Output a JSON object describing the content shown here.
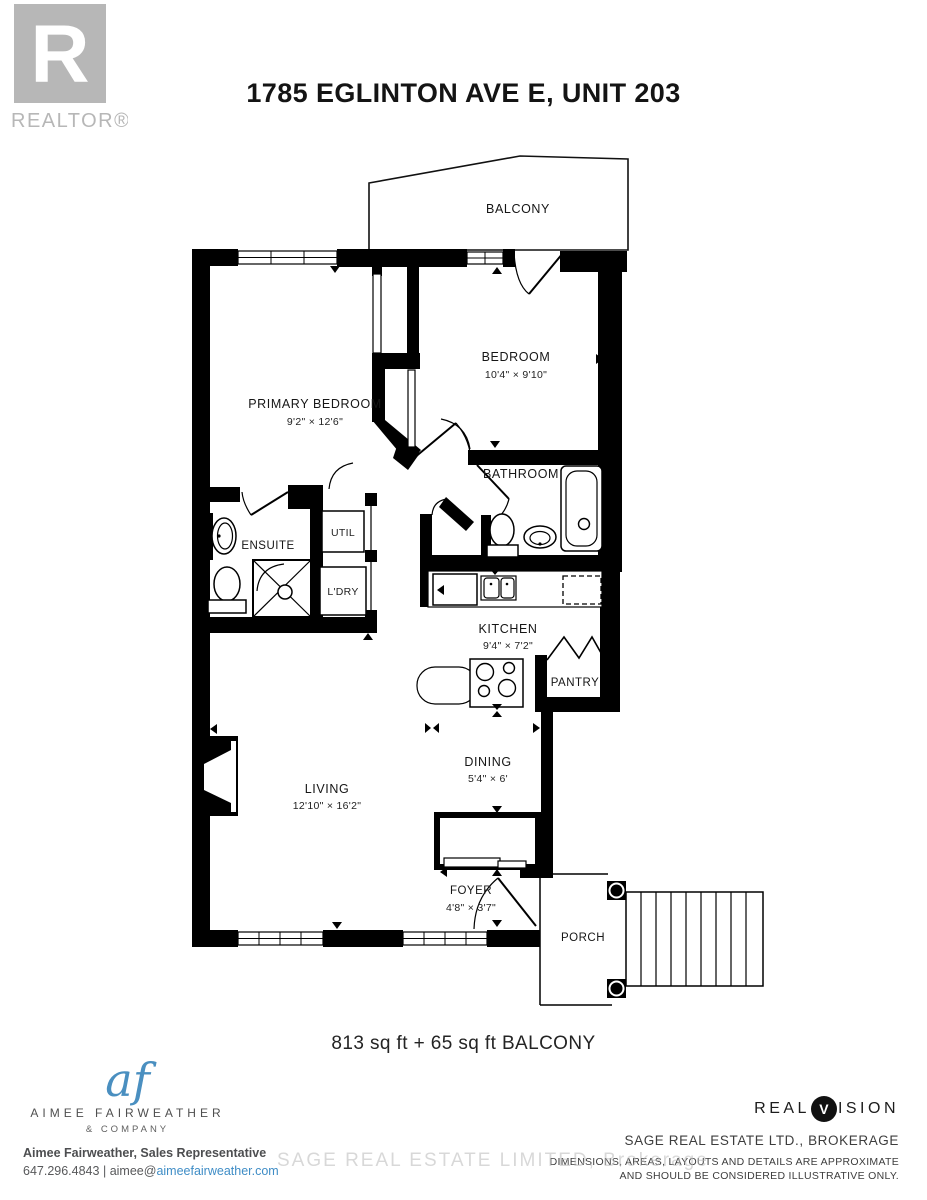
{
  "colors": {
    "wall": "#000000",
    "logo_gray": "#b7b7b7",
    "accent_blue": "#3f8dc6",
    "text_dark": "#1a1a1a",
    "watermark_gray": "#b9b9b9"
  },
  "header": {
    "title": "1785 EGLINTON AVE E, UNIT 203",
    "realtor_logo": {
      "letter": "R",
      "wordmark": "REALTOR®"
    }
  },
  "floorplan": {
    "area_text": "813 sq ft + 65 sq ft BALCONY",
    "rooms": {
      "balcony": {
        "label": "BALCONY"
      },
      "primary_bedroom": {
        "label": "PRIMARY BEDROOM",
        "dims": "9'2\" × 12'6\""
      },
      "bedroom": {
        "label": "BEDROOM",
        "dims": "10'4\" × 9'10\""
      },
      "bathroom": {
        "label": "BATHROOM"
      },
      "ensuite": {
        "label": "ENSUITE"
      },
      "util": {
        "label": "UTIL"
      },
      "laundry": {
        "label": "L'DRY"
      },
      "kitchen": {
        "label": "KITCHEN",
        "dims": "9'4\" × 7'2\""
      },
      "pantry": {
        "label": "PANTRY"
      },
      "dining": {
        "label": "DINING",
        "dims": "5'4\" × 6'"
      },
      "living": {
        "label": "LIVING",
        "dims": "12'10\" × 16'2\""
      },
      "foyer": {
        "label": "FOYER",
        "dims": "4'8\" × 3'7\""
      },
      "porch": {
        "label": "PORCH"
      }
    }
  },
  "footer": {
    "agency": {
      "monogram": "af",
      "name": "AIMEE FAIRWEATHER",
      "tagline": "& COMPANY"
    },
    "agent": {
      "name_line": "Aimee Fairweather, Sales Representative",
      "phone": "647.296.4843",
      "separator": "|",
      "email_prefix": "aimee@",
      "email_domain": "aimeefairweather.com"
    },
    "brokerage": {
      "logo_left": "REAL",
      "logo_v": "V",
      "logo_right": "ISION",
      "name": "SAGE REAL ESTATE LTD., BROKERAGE",
      "disclaimer1": "DIMENSIONS, AREAS, LAYOUTS AND DETAILS ARE APPROXIMATE",
      "disclaimer2": "AND SHOULD BE CONSIDERED ILLUSTRATIVE ONLY."
    },
    "watermark": "SAGE REAL ESTATE LIMITED, Brokerage"
  }
}
